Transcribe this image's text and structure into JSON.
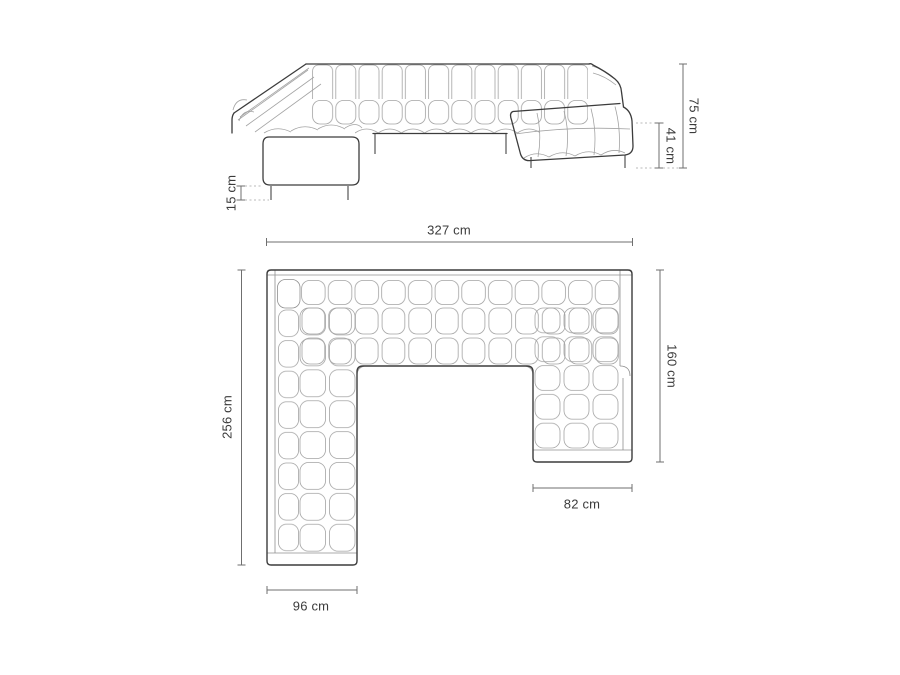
{
  "colors": {
    "outline": "#3c3c3c",
    "texture": "#a3a3a3",
    "frame": "#8f8f8f",
    "dimension_line": "#6f6f6f",
    "label_text": "#3b3b3b",
    "dotted": "#b8b8b8",
    "background": "#ffffff"
  },
  "front_view": {
    "dimensions": [
      {
        "id": "total-height",
        "label": "75 cm"
      },
      {
        "id": "seat-height",
        "label": "41 cm"
      },
      {
        "id": "leg-height",
        "label": "15 cm"
      },
      {
        "id": "total-width",
        "label": "327 cm"
      }
    ]
  },
  "plan_view": {
    "dimensions": [
      {
        "id": "total-depth",
        "label": "256 cm"
      },
      {
        "id": "right-arm-depth",
        "label": "160 cm"
      },
      {
        "id": "right-arm-width",
        "label": "82 cm"
      },
      {
        "id": "left-arm-width",
        "label": "96 cm"
      }
    ]
  }
}
